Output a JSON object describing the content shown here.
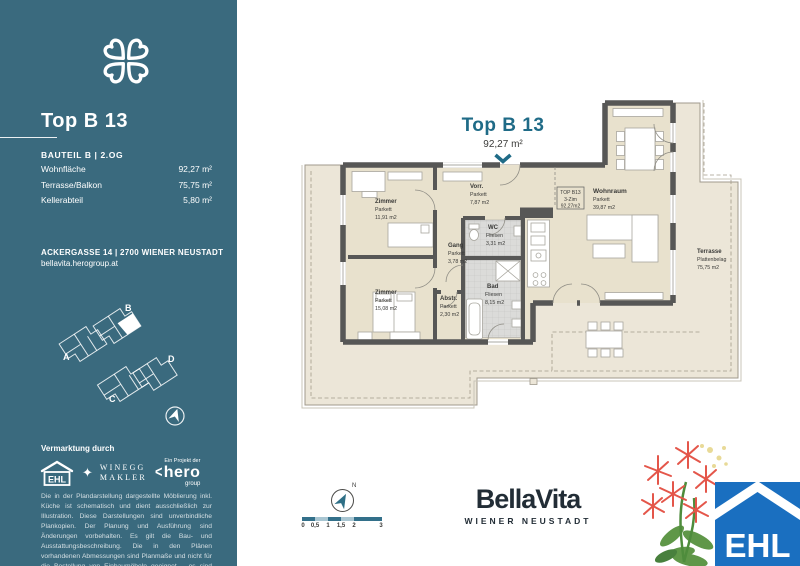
{
  "sidebar": {
    "title": "Top B 13",
    "unit_meta": "BAUTEIL B | 2.OG",
    "details": [
      {
        "label": "Wohnfläche",
        "value": "92,27 m²"
      },
      {
        "label": "Terrasse/Balkon",
        "value": "75,75 m²"
      },
      {
        "label": "Kellerabteil",
        "value": "5,80 m²"
      }
    ],
    "address": "ACKERGASSE 14 | 2700 WIENER NEUSTADT",
    "website": "bellavita.herogroup.at",
    "sitemap_labels": [
      "A",
      "B",
      "C",
      "D"
    ],
    "marketing_heading": "Vermarktung durch",
    "ehl_label": "EHL",
    "winegg_line1": "WINEGG",
    "winegg_line2": "MAKLER",
    "hero_prefix": "Ein Projekt der",
    "hero_name": "hero",
    "hero_suffix": "group",
    "disclaimer": "Die in der Plandarstellung dargestellte Möblierung inkl. Küche ist schematisch und dient ausschließlich zur Illustration. Diese Darstellungen sind unverbindliche Plankopien. Der Planung und Ausführung sind Änderungen vorbehalten. Es gilt die Bau- und Ausstattungsbeschreibung. Die in den Plänen vorhandenen Abmessungen sind Planmaße und nicht für die Bestellung von Einbaumöbeln geeignet – es sind Naturmaße zu nehmen."
  },
  "plan": {
    "title": "Top B 13",
    "area": "92,27 m²",
    "unit_box": {
      "line1": "TOP B13",
      "line2": "3-Zim",
      "line3": "92,27m2"
    },
    "rooms": [
      {
        "name": "Zimmer",
        "floor": "Parkett",
        "area": "11,91 m2"
      },
      {
        "name": "Vorr.",
        "floor": "Parkett",
        "area": "7,87 m2"
      },
      {
        "name": "Gang",
        "floor": "Parkett",
        "area": "3,78 m2"
      },
      {
        "name": "WC",
        "floor": "Fliesen",
        "area": "3,31 m2"
      },
      {
        "name": "Bad",
        "floor": "Fliesen",
        "area": "8,15 m2"
      },
      {
        "name": "Abstr.",
        "floor": "Parkett",
        "area": "2,30 m2"
      },
      {
        "name": "Zimmer",
        "floor": "Parkett",
        "area": "15,08 m2"
      },
      {
        "name": "Wohnraum",
        "floor": "Parkett",
        "area": "39,87 m2"
      },
      {
        "name": "Terrasse",
        "floor": "Plattenbelag",
        "area": "75,75 m2"
      }
    ]
  },
  "footer": {
    "north_label": "N",
    "scale_marks": [
      "0",
      "0,5",
      "1",
      "1,5",
      "2",
      "3"
    ],
    "brand": "BellaVita",
    "brand_subtitle": "WIENER NEUSTADT"
  },
  "ehl_badge_label": "EHL",
  "colors": {
    "sidebar_teal": "#3a6a7e",
    "plan_title_teal": "#1f6b87",
    "ehl_blue": "#1a6fc0",
    "wall_gray": "#575756",
    "room_beige": "#e8e1cd",
    "terrace_beige": "#ece6d8",
    "scale_teal": "#33708a"
  }
}
